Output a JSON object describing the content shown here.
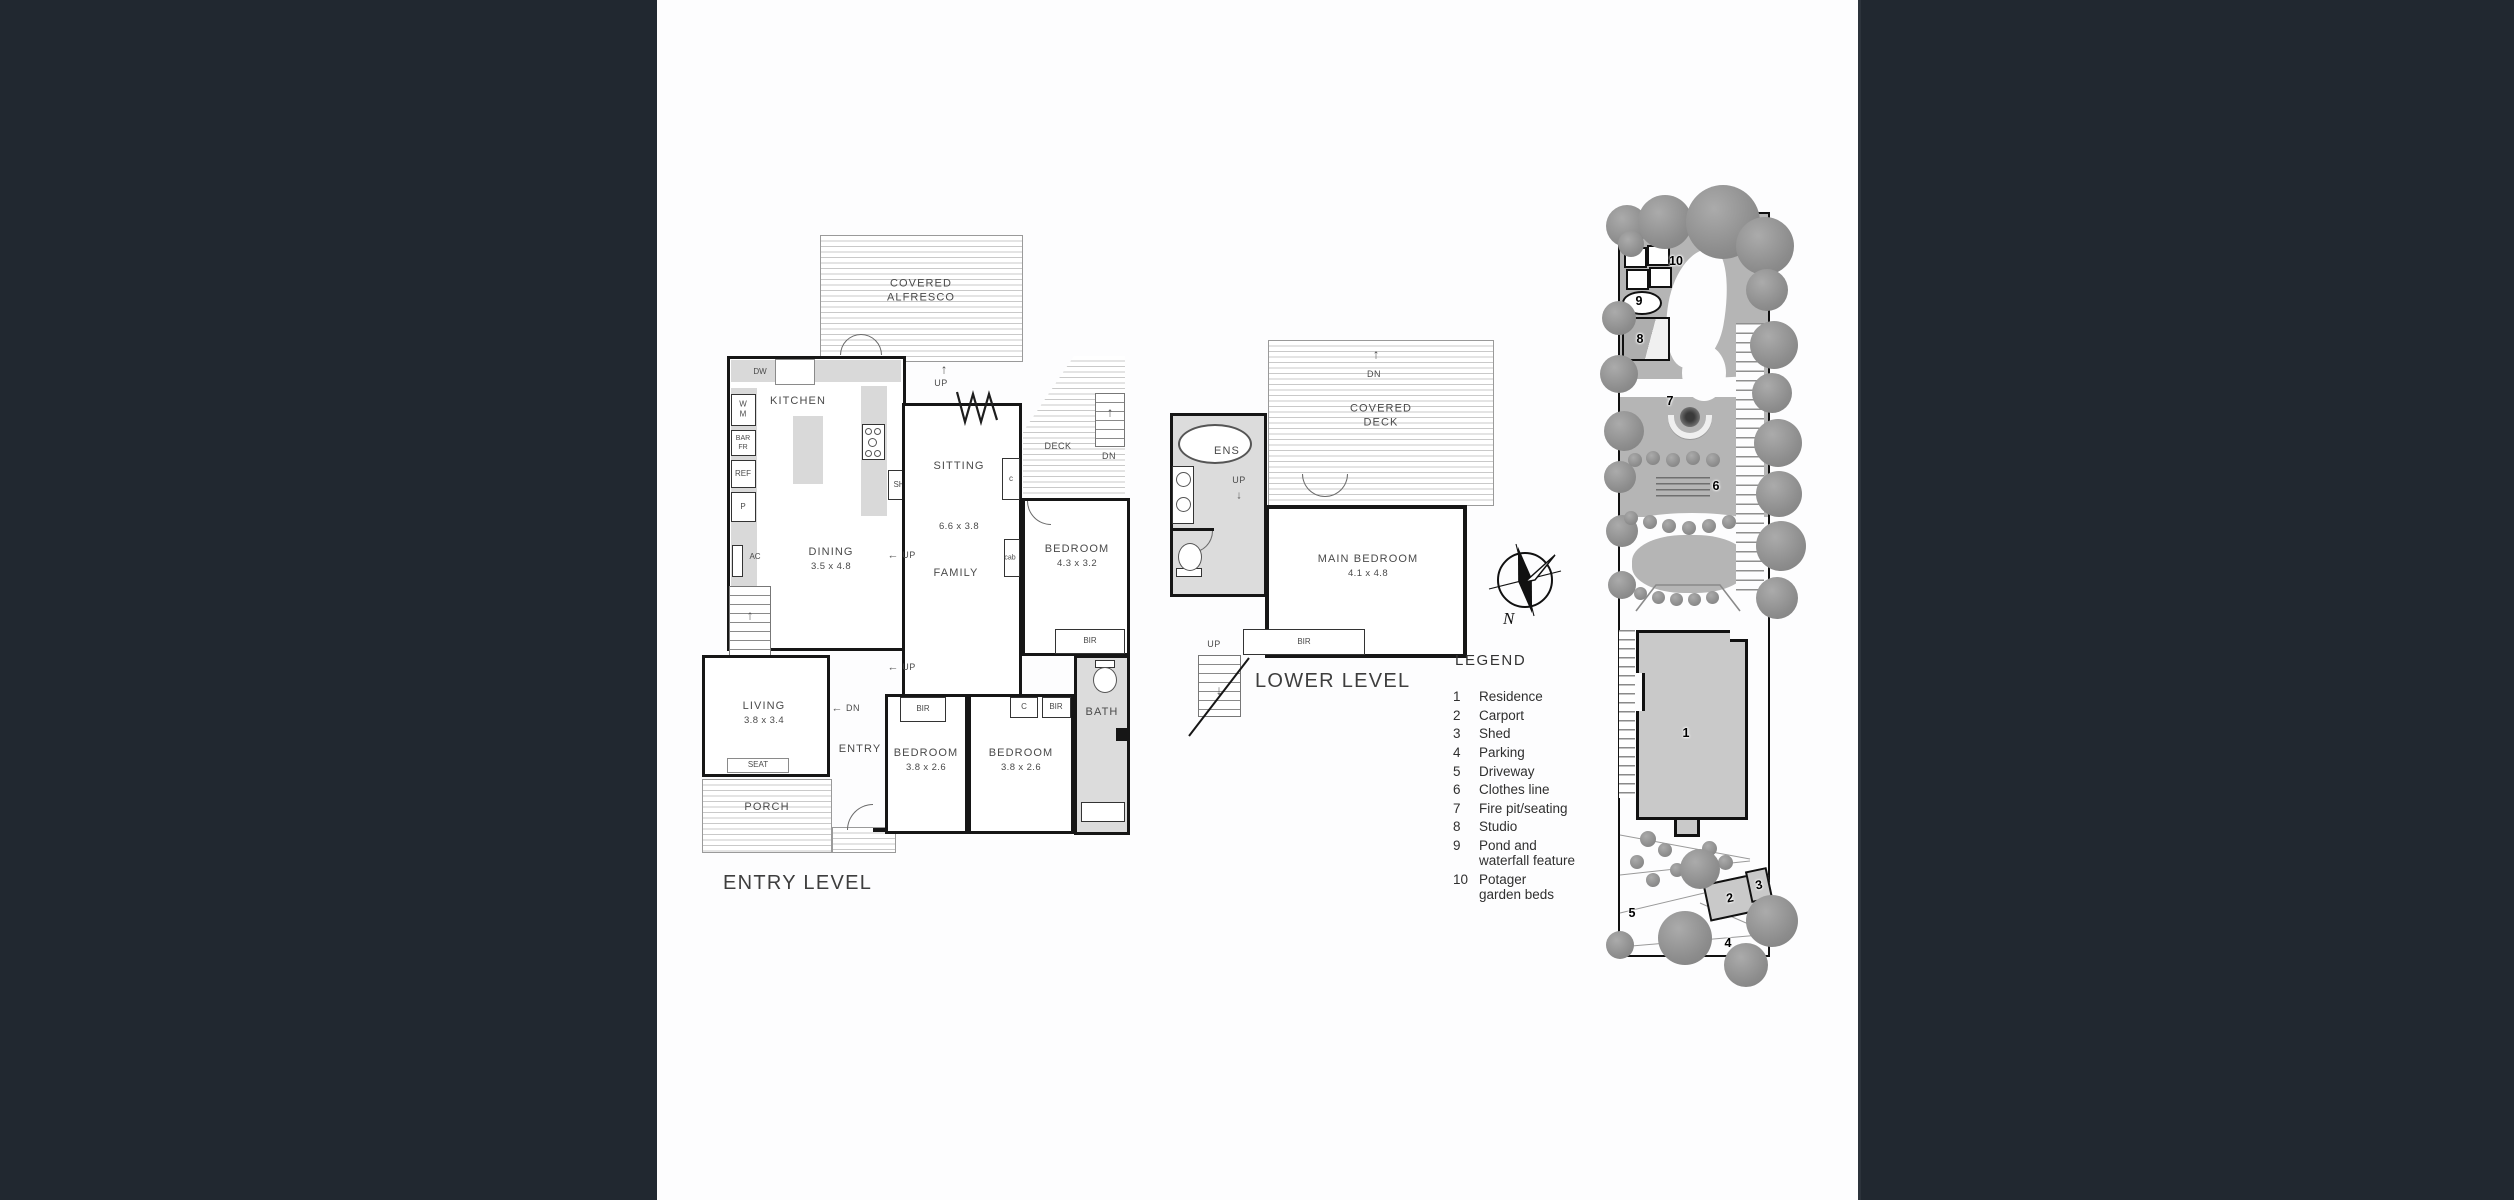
{
  "colors": {
    "sidebar_bg": "#212830",
    "paper_bg": "#fdfdfe",
    "wall": "#161616",
    "room_fill": "#dcdcdc",
    "site_lawn": "#b5b5b5",
    "site_tree": "#8d8d8d"
  },
  "icons": {
    "up_arrow": "↑",
    "down_arrow": "↓",
    "left_arrow": "←"
  },
  "entry_level": {
    "title": "ENTRY LEVEL",
    "covered_alfresco": "COVERED\nALFRESCO",
    "kitchen": "KITCHEN",
    "dining": "DINING",
    "dining_dim": "3.5 x 4.8",
    "sitting": "SITTING",
    "sitting_dim": "6.6 x 3.8",
    "family": "FAMILY",
    "deck": "DECK",
    "bedroom_right": "BEDROOM",
    "bedroom_right_dim": "4.3 x 3.2",
    "bedroom_a": "BEDROOM",
    "bedroom_a_dim": "3.8 x 2.6",
    "bedroom_b": "BEDROOM",
    "bedroom_b_dim": "3.8 x 2.6",
    "living": "LIVING",
    "living_dim": "3.8 x 3.4",
    "bath": "BATH",
    "entry": "ENTRY",
    "seat": "SEAT",
    "porch": "PORCH",
    "up": "UP",
    "dn": "DN",
    "dw": "DW",
    "wm": "W\nM",
    "bar_fr": "BAR\nFR",
    "ref": "REF",
    "p": "P",
    "ac": "AC",
    "sh": "SH",
    "c_small": "c",
    "cab": "cab",
    "c_upper": "C",
    "bir": "BIR"
  },
  "lower_level": {
    "title": "LOWER LEVEL",
    "covered_deck": "COVERED\nDECK",
    "ens": "ENS",
    "main_bedroom": "MAIN BEDROOM",
    "main_bedroom_dim": "4.1 x 4.8",
    "bir": "BIR",
    "up": "UP",
    "dn": "DN"
  },
  "compass": {
    "north": "N"
  },
  "legend": {
    "title": "LEGEND",
    "items": [
      {
        "num": "1",
        "label": "Residence"
      },
      {
        "num": "2",
        "label": "Carport"
      },
      {
        "num": "3",
        "label": "Shed"
      },
      {
        "num": "4",
        "label": "Parking"
      },
      {
        "num": "5",
        "label": "Driveway"
      },
      {
        "num": "6",
        "label": "Clothes line"
      },
      {
        "num": "7",
        "label": "Fire pit/seating"
      },
      {
        "num": "8",
        "label": "Studio"
      },
      {
        "num": "9",
        "label": "Pond and\nwaterfall feature"
      },
      {
        "num": "10",
        "label": "Potager\ngarden beds"
      }
    ]
  },
  "site_plan": {
    "markers": [
      "1",
      "2",
      "3",
      "4",
      "5",
      "6",
      "7",
      "8",
      "9",
      "10"
    ]
  }
}
